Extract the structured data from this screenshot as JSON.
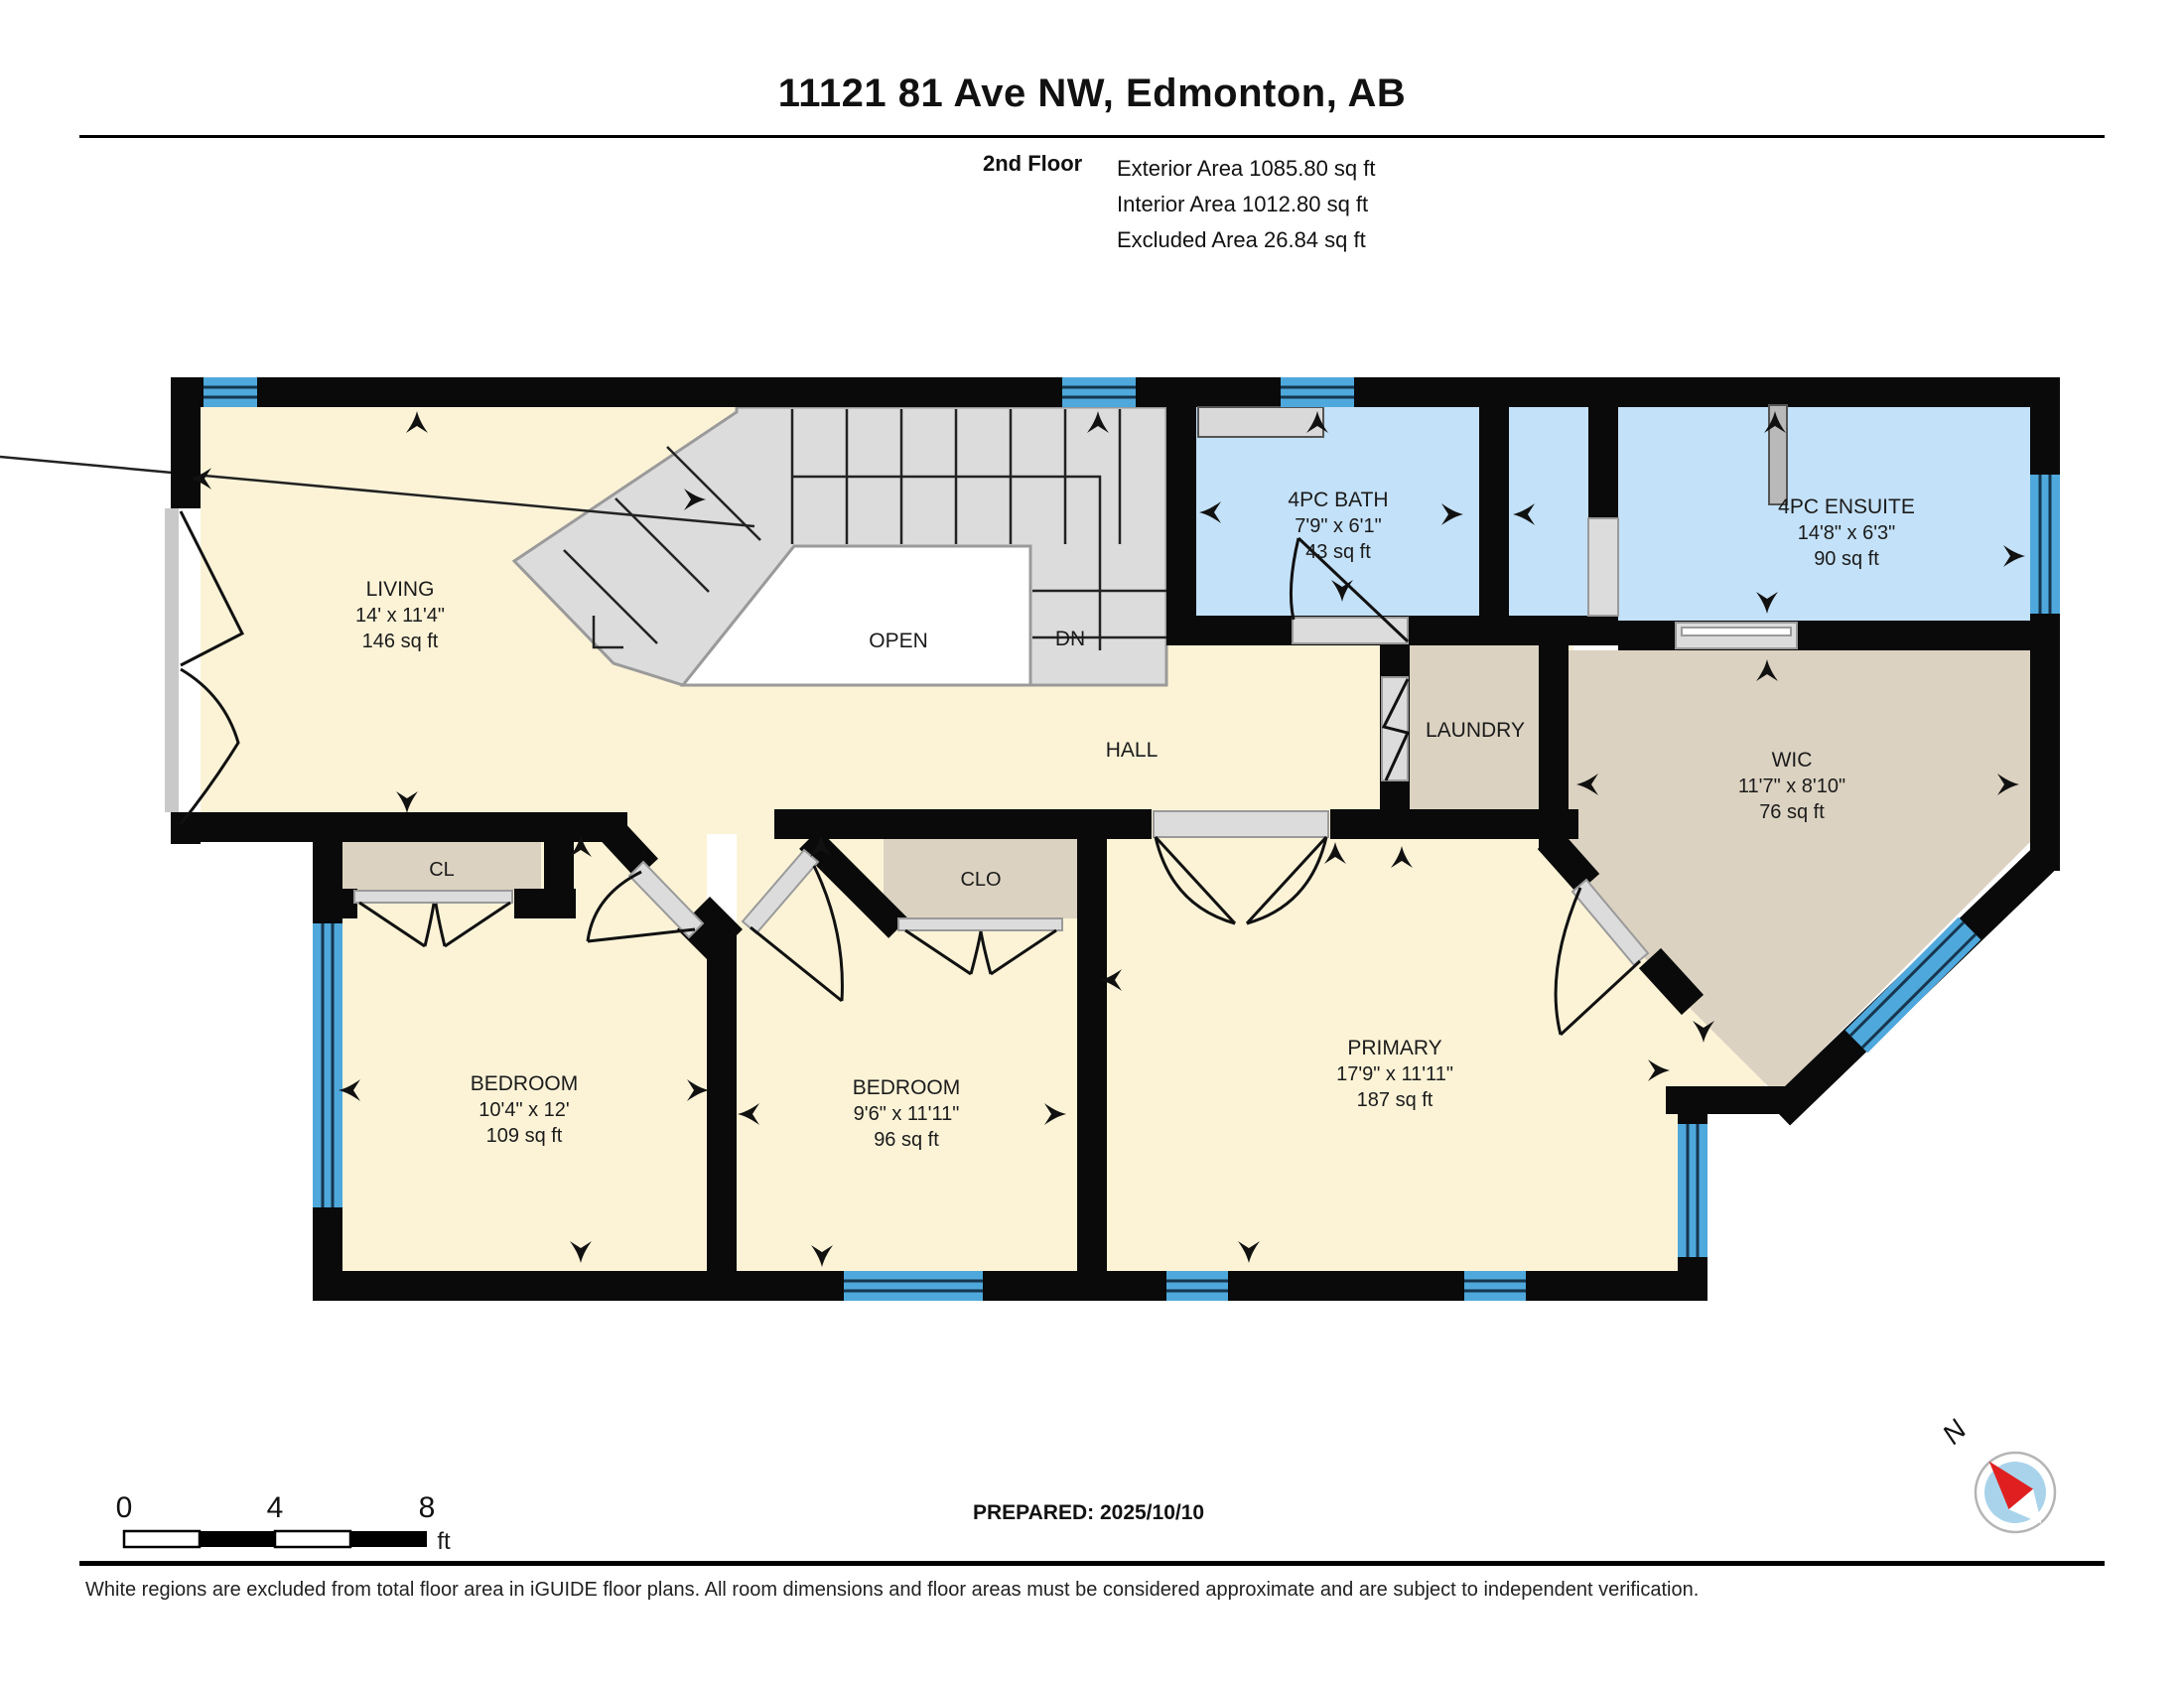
{
  "header": {
    "title": "11121 81 Ave NW, Edmonton, AB",
    "floor_label": "2nd Floor",
    "exterior_area": "Exterior Area 1085.80 sq ft",
    "interior_area": "Interior Area 1012.80 sq ft",
    "excluded_area": "Excluded Area 26.84 sq ft"
  },
  "rooms": {
    "living": {
      "name": "LIVING",
      "dims": "14' x 11'4\"",
      "area": "146 sq ft"
    },
    "bath": {
      "name": "4PC BATH",
      "dims": "7'9\" x 6'1\"",
      "area": "43 sq ft"
    },
    "ensuite": {
      "name": "4PC ENSUITE",
      "dims": "14'8\" x 6'3\"",
      "area": "90 sq ft"
    },
    "wic": {
      "name": "WIC",
      "dims": "11'7\" x 8'10\"",
      "area": "76 sq ft"
    },
    "laundry": {
      "name": "LAUNDRY"
    },
    "hall": {
      "name": "HALL"
    },
    "open": {
      "name": "OPEN"
    },
    "stairs": {
      "dn_label": "DN"
    },
    "bedroom1": {
      "name": "BEDROOM",
      "dims": "10'4\" x 12'",
      "area": "109 sq ft"
    },
    "bedroom2": {
      "name": "BEDROOM",
      "dims": "9'6\" x 11'11\"",
      "area": "96 sq ft"
    },
    "primary": {
      "name": "PRIMARY",
      "dims": "17'9\" x 11'11\"",
      "area": "187 sq ft"
    },
    "closet1": {
      "name": "CL"
    },
    "closet2": {
      "name": "CLO"
    }
  },
  "footer": {
    "scale_ticks": [
      "0",
      "4",
      "8"
    ],
    "scale_unit": "ft",
    "prepared": "PREPARED: 2025/10/10",
    "compass_label": "N",
    "disclaimer": "White regions are excluded from total floor area in iGUIDE floor plans. All room dimensions and floor areas must be considered approximate and are subject to independent verification."
  },
  "colors": {
    "wall_black": "#0a0a0a",
    "floor_cream": "#fcf3d7",
    "floor_tan": "#dbd2c1",
    "floor_blue": "#c3e1f8",
    "stairs_gray": "#dcdcdc",
    "open_white": "#ffffff",
    "window_blue": "#4fa8dc",
    "window_line": "#16364e",
    "compass_red": "#e02020",
    "compass_blue": "#a9d3eb"
  }
}
